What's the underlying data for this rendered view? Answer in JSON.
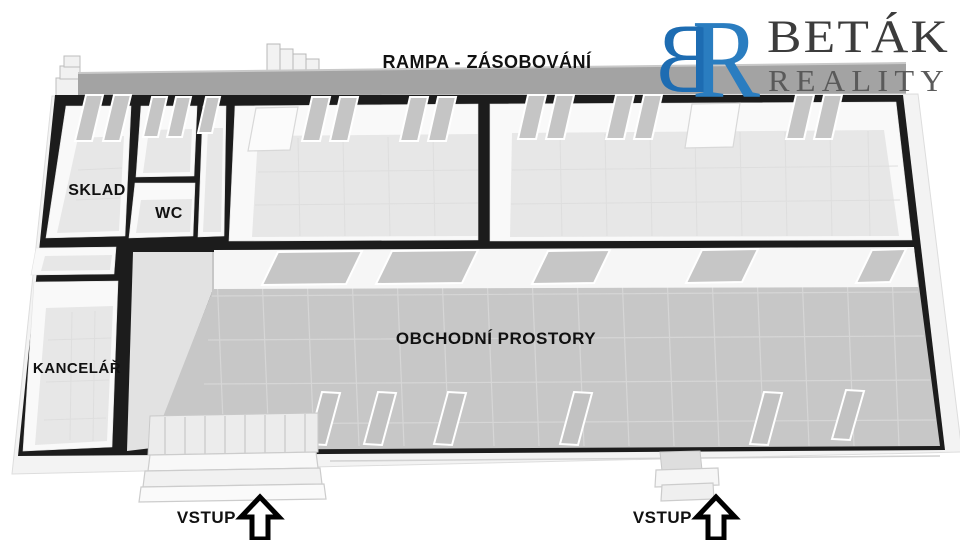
{
  "logo": {
    "monogram": {
      "left_letter": "B",
      "right_letter": "R",
      "left_color": "#1d6cb2",
      "right_color": "#2a7dc0"
    },
    "company_name": "BETÁK",
    "division": "REALITY",
    "company_color": "#3c3c3c",
    "division_color": "#5a5a5a"
  },
  "plan": {
    "ramp_label": "RAMPA - ZÁSOBOVÁNÍ",
    "rooms": {
      "storage_label": "SKLAD",
      "wc_label": "WC",
      "office_label": "KANCELÁŘ",
      "sales_label": "OBCHODNÍ PROSTORY"
    },
    "entrances": {
      "left_label": "VSTUP",
      "right_label": "VSTUP"
    },
    "colors": {
      "wall": "#1c1c1c",
      "ramp": "#a3a3a3",
      "sales_floor": "#c7c7c7",
      "room_floor": "#e7e7e7",
      "label": "#111111",
      "arrow_outline": "#000000",
      "arrow_fill": "#ffffff"
    }
  }
}
